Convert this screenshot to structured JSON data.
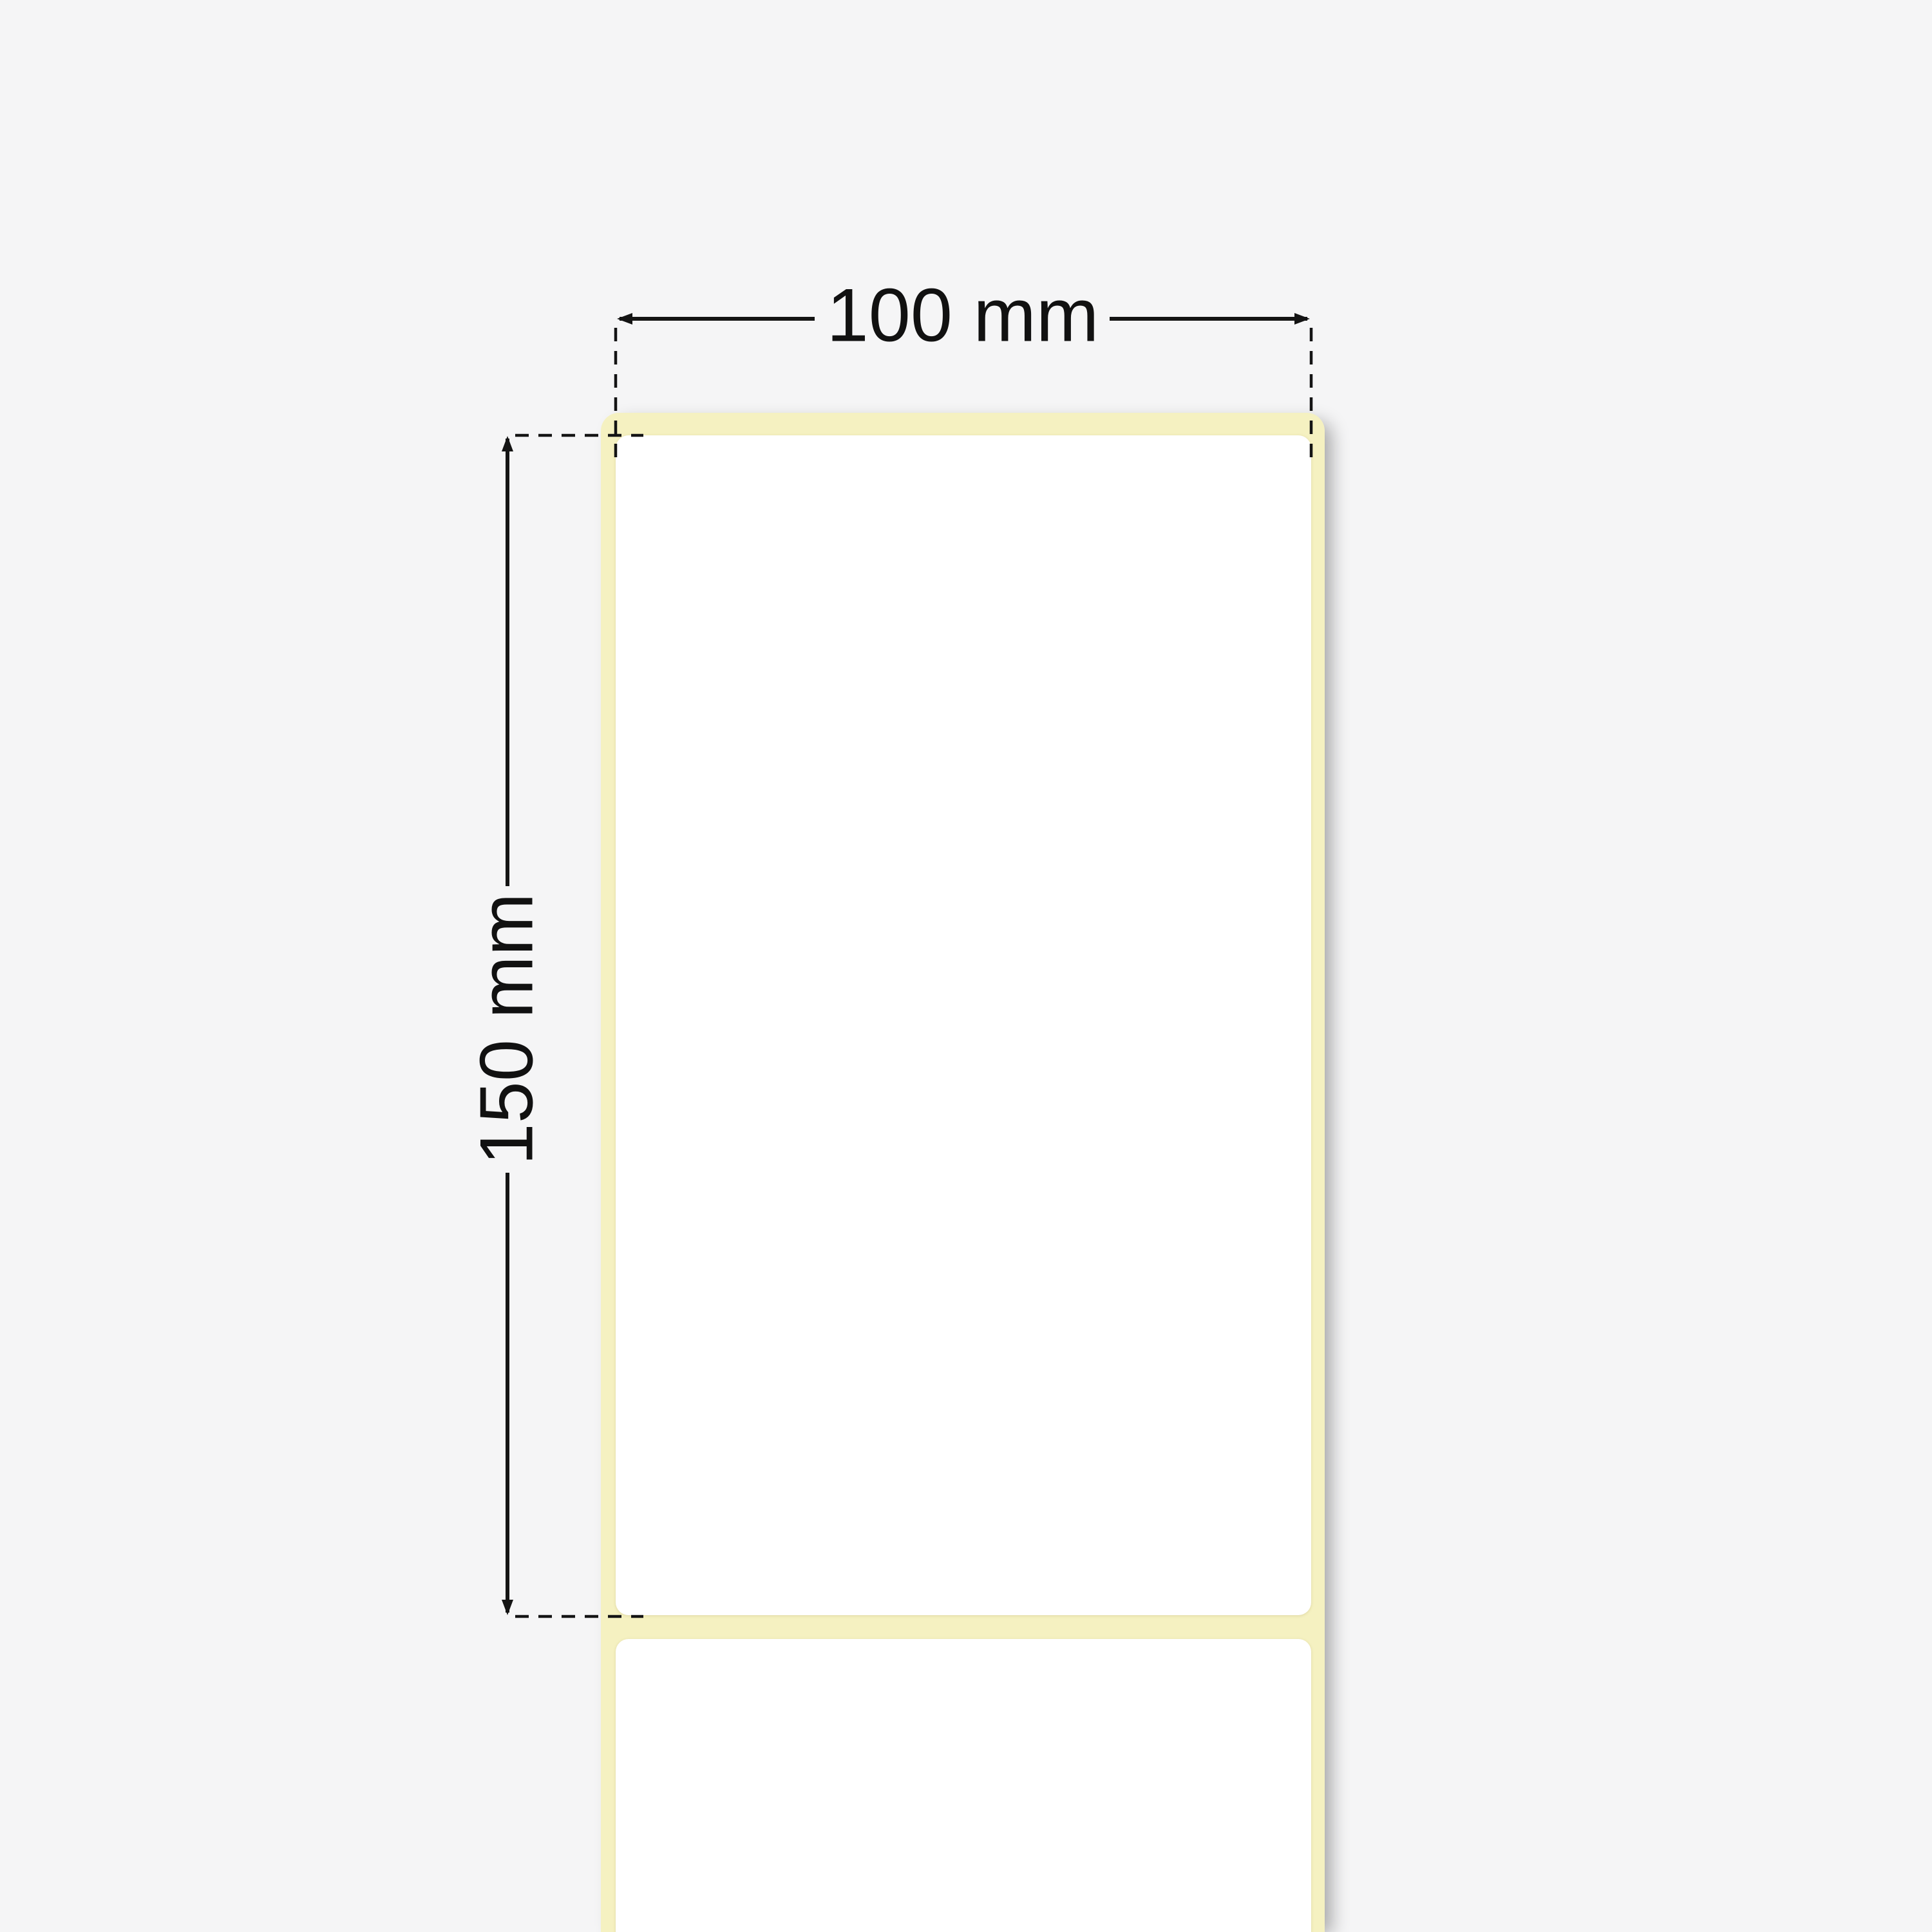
{
  "meta": {
    "title": "Label roll dimension diagram",
    "description": "Blank thermal labels on a continuous liner strip with width and height dimension annotations"
  },
  "dimensions": {
    "width": {
      "label": "100 mm"
    },
    "height": {
      "label": "150 mm"
    }
  },
  "roll": {
    "labels_visible": 2,
    "liner_color": "#f5f1c1",
    "label_color": "#ffffff"
  },
  "style": {
    "background_color": "#f5f5f6",
    "line_color": "#141414",
    "shadow_color": "rgba(0,0,0,0.33)"
  }
}
